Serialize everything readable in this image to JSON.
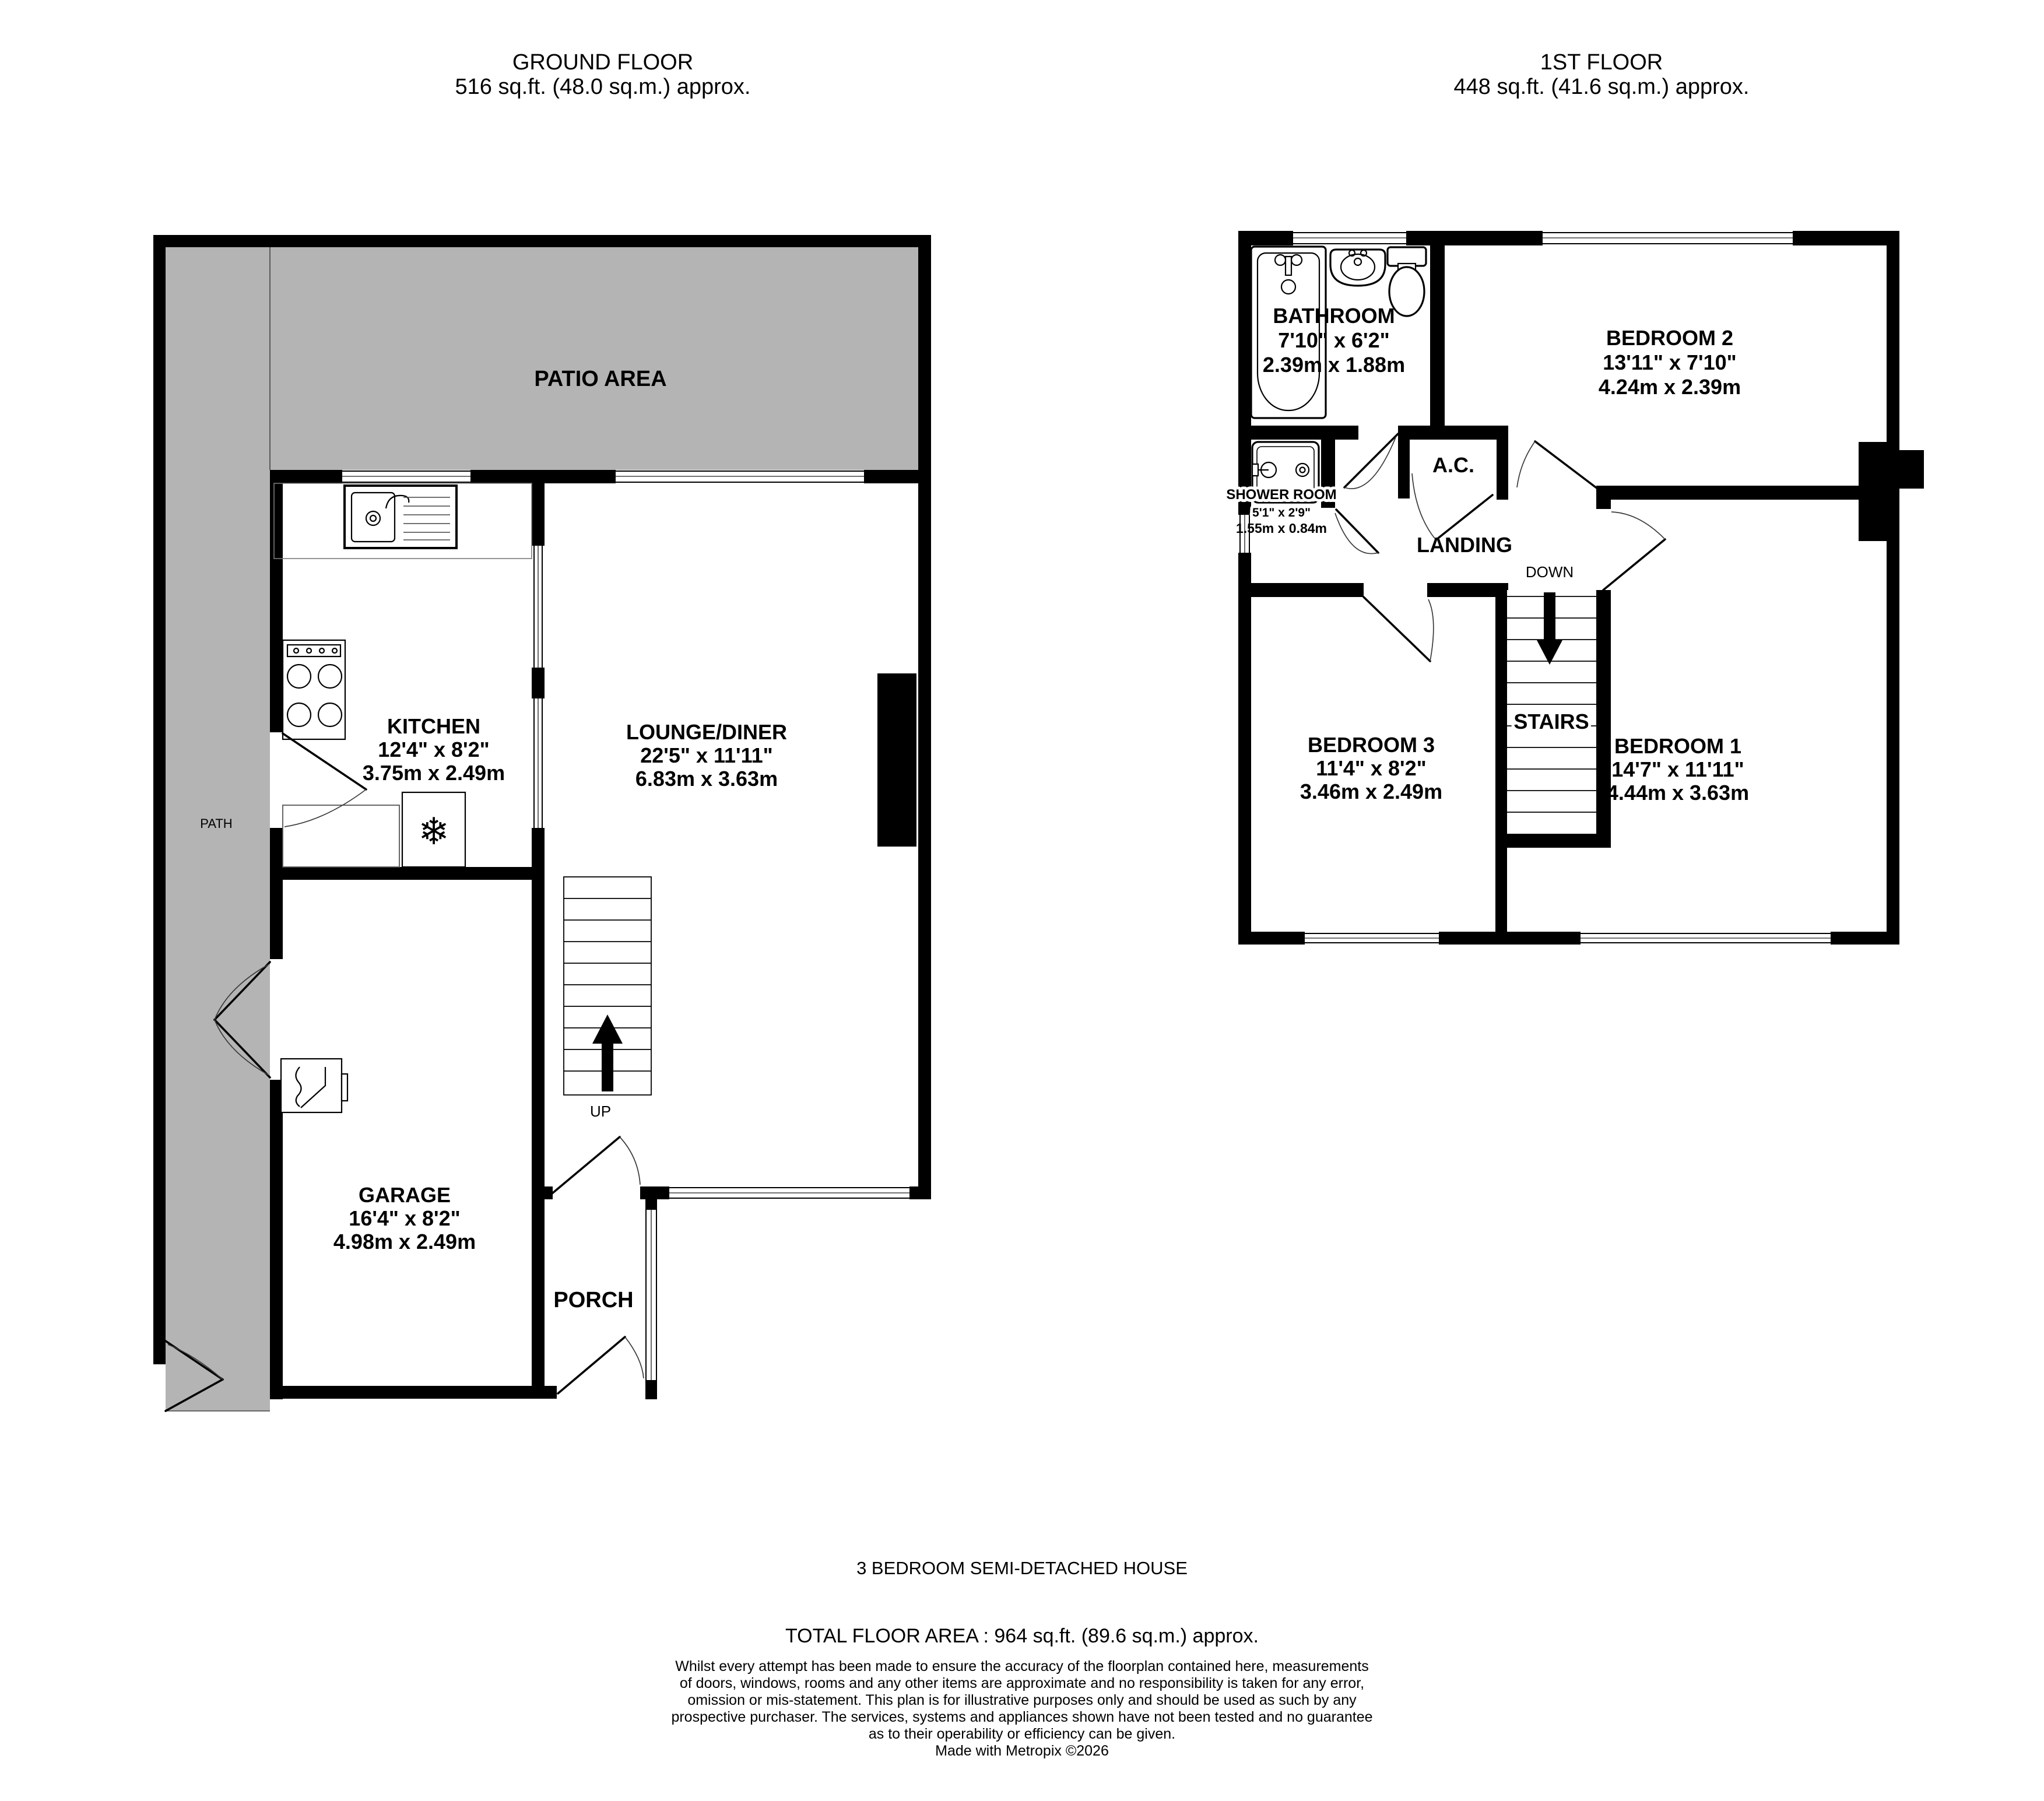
{
  "colors": {
    "wall": "#000000",
    "outdoor": "#b4b4b4"
  },
  "icons": {
    "freezer_snowflake": "❄"
  },
  "header_ground": {
    "title": "GROUND FLOOR",
    "area": "516 sq.ft. (48.0 sq.m.) approx."
  },
  "header_first": {
    "title": "1ST FLOOR",
    "area": "448 sq.ft. (41.6 sq.m.) approx."
  },
  "ground": {
    "patio_label": "PATIO AREA",
    "path_label": "PATH",
    "up_label": "UP",
    "kitchen": {
      "name": "KITCHEN",
      "imperial": "12'4\" x 8'2\"",
      "metric": "3.75m x 2.49m"
    },
    "lounge": {
      "name": "LOUNGE/DINER",
      "imperial": "22'5\" x 11'11\"",
      "metric": "6.83m x 3.63m"
    },
    "garage": {
      "name": "GARAGE",
      "imperial": "16'4\" x 8'2\"",
      "metric": "4.98m x 2.49m"
    },
    "porch": {
      "name": "PORCH"
    }
  },
  "first": {
    "landing_label": "LANDING",
    "down_label": "DOWN",
    "stairs_label": "STAIRS",
    "ac_label": "A.C.",
    "bathroom": {
      "name": "BATHROOM",
      "imperial": "7'10\" x 6'2\"",
      "metric": "2.39m x 1.88m"
    },
    "bedroom2": {
      "name": "BEDROOM 2",
      "imperial": "13'11\" x 7'10\"",
      "metric": "4.24m x 2.39m"
    },
    "shower": {
      "name": "SHOWER ROOM",
      "imperial": "5'1\" x 2'9\"",
      "metric": "1.55m x 0.84m"
    },
    "bedroom3": {
      "name": "BEDROOM 3",
      "imperial": "11'4\" x 8'2\"",
      "metric": "3.46m x 2.49m"
    },
    "bedroom1": {
      "name": "BEDROOM 1",
      "imperial": "14'7\" x 11'11\"",
      "metric": "4.44m x 3.63m"
    }
  },
  "footer": {
    "property_type": "3 BEDROOM SEMI-DETACHED HOUSE",
    "total_area": "TOTAL FLOOR AREA : 964 sq.ft. (89.6 sq.m.) approx.",
    "disclaimer": [
      "Whilst every attempt has been made to ensure the accuracy of the floorplan contained here, measurements",
      "of doors, windows, rooms and any other items are approximate and no responsibility is taken for any error,",
      "omission or mis-statement. This plan is for illustrative purposes only and should be used as such by any",
      "prospective purchaser. The services, systems and appliances shown have not been tested and no guarantee",
      "as to their operability or efficiency can be given."
    ],
    "credit": "Made with Metropix ©2026"
  }
}
